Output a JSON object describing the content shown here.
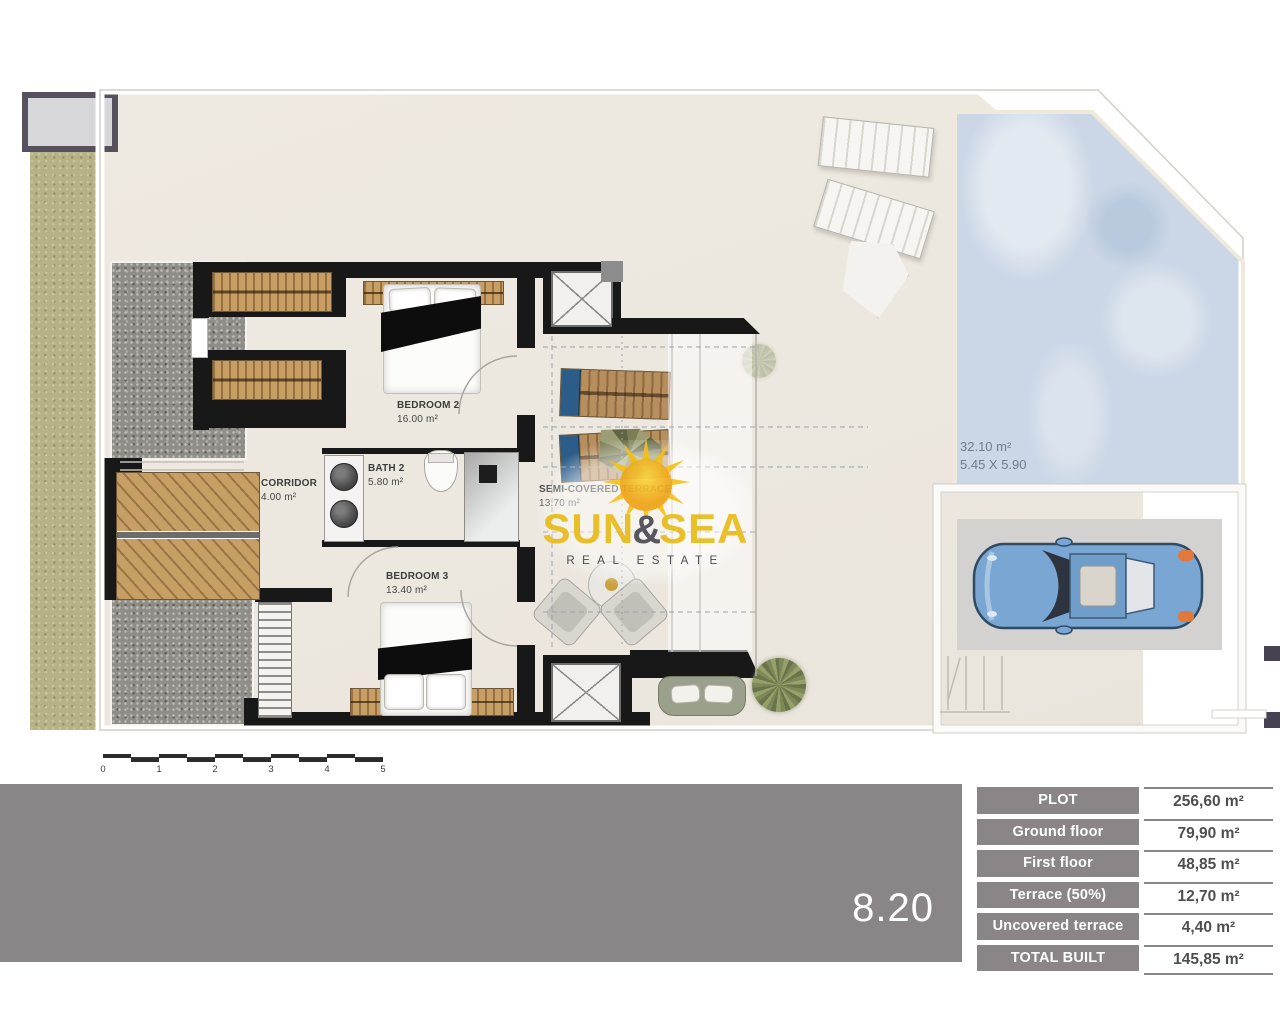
{
  "branding": {
    "word1": "SUN",
    "amp": "&",
    "word2": "SEA",
    "tagline": "REAL ESTATE",
    "sun_color": "#f6c41f",
    "text_color": "#e9bc1c"
  },
  "plan": {
    "number": "8.20",
    "rooms": [
      {
        "name": "BEDROOM 2",
        "area": "16.00 m²"
      },
      {
        "name": "CORRIDOR",
        "area": "4.00 m²"
      },
      {
        "name": "BATH 2",
        "area": "5.80 m²"
      },
      {
        "name": "BEDROOM 3",
        "area": "13.40 m²"
      },
      {
        "name": "SEMI-COVERED TERRACE",
        "area": "13.70 m²"
      }
    ],
    "pool": {
      "area": "32.10 m²",
      "dimensions": "5.45 X 5.90"
    },
    "scale_labels": [
      "0",
      "1",
      "2",
      "3",
      "4",
      "5"
    ]
  },
  "areas_table": {
    "rows": [
      {
        "label": "PLOT",
        "value": "256,60 m²"
      },
      {
        "label": "Ground floor",
        "value": "79,90 m²"
      },
      {
        "label": "First floor",
        "value": "48,85 m²"
      },
      {
        "label": "Terrace (50%)",
        "value": "12,70 m²"
      },
      {
        "label": "Uncovered terrace",
        "value": "4,40 m²"
      },
      {
        "label": "TOTAL BUILT",
        "value": "145,85 m²"
      }
    ]
  },
  "colors": {
    "footer_bar": "#8a8586",
    "pool_water": "#cbd7e6",
    "garden_green": "#b5b286",
    "wood": "#c79e63",
    "wall": "#181818",
    "car_blue": "#79a6d2"
  }
}
